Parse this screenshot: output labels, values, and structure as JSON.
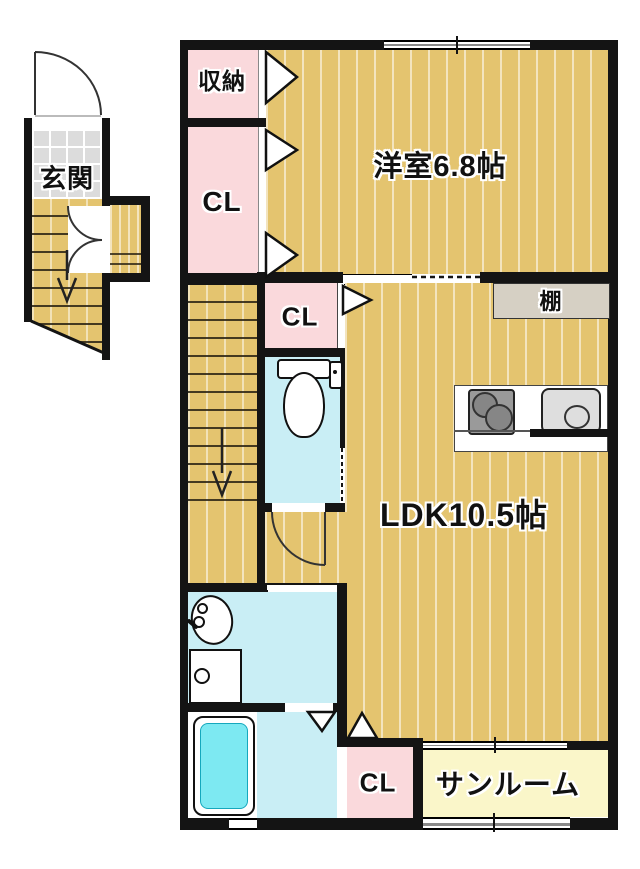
{
  "rooms": {
    "genkan": "玄関",
    "storage": "収納",
    "closet_upper": "CL",
    "western_room": "洋室6.8帖",
    "closet_middle": "CL",
    "shelf": "棚",
    "ldk": "LDK10.5帖",
    "closet_lower": "CL",
    "sunroom": "サンルーム"
  },
  "colors": {
    "wall": "#141414",
    "wood_floor": "#e4c46f",
    "closet_pink": "#fad9dc",
    "wet_area_blue": "#c9eef5",
    "bathtub_cyan": "#7de9f2",
    "sunroom_yellow": "#faf6c9",
    "entry_tile_gray": "#dcdcdc",
    "shelf_gray": "#d6d0c4"
  }
}
